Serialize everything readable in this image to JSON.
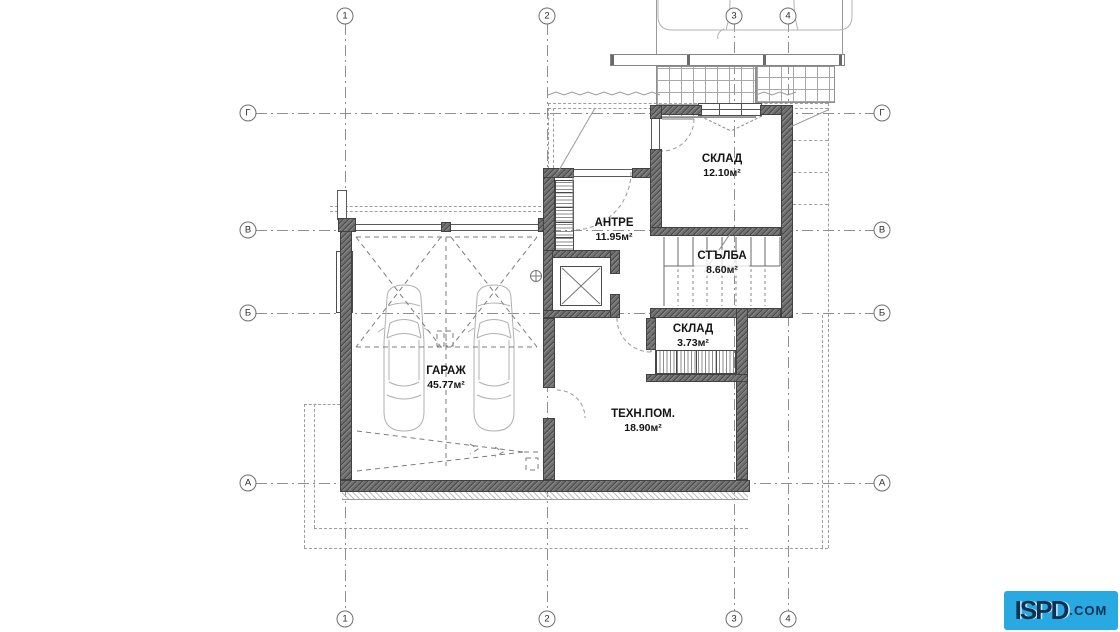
{
  "grid": {
    "columns": [
      "1",
      "2",
      "3",
      "4"
    ],
    "rows": [
      "Г",
      "В",
      "Б",
      "А"
    ]
  },
  "rooms": [
    {
      "name": "СКЛАД",
      "area": "12.10м²"
    },
    {
      "name": "АНТРЕ",
      "area": "11.95м²"
    },
    {
      "name": "СТЪЛБА",
      "area": "8.60м²"
    },
    {
      "name": "СКЛАД",
      "area": "3.73м²"
    },
    {
      "name": "ГАРАЖ",
      "area": "45.77м²"
    },
    {
      "name": "ТЕХН.ПОМ.",
      "area": "18.90м²"
    }
  ],
  "watermark": {
    "text_main": "ISPD",
    "text_suffix": ".COM",
    "bg_color": "#29a9e2",
    "fg_color": "#0e3052"
  },
  "colors": {
    "wall_fill": "#6f6f6f",
    "line": "#8f8f8f",
    "background": "#ffffff"
  }
}
